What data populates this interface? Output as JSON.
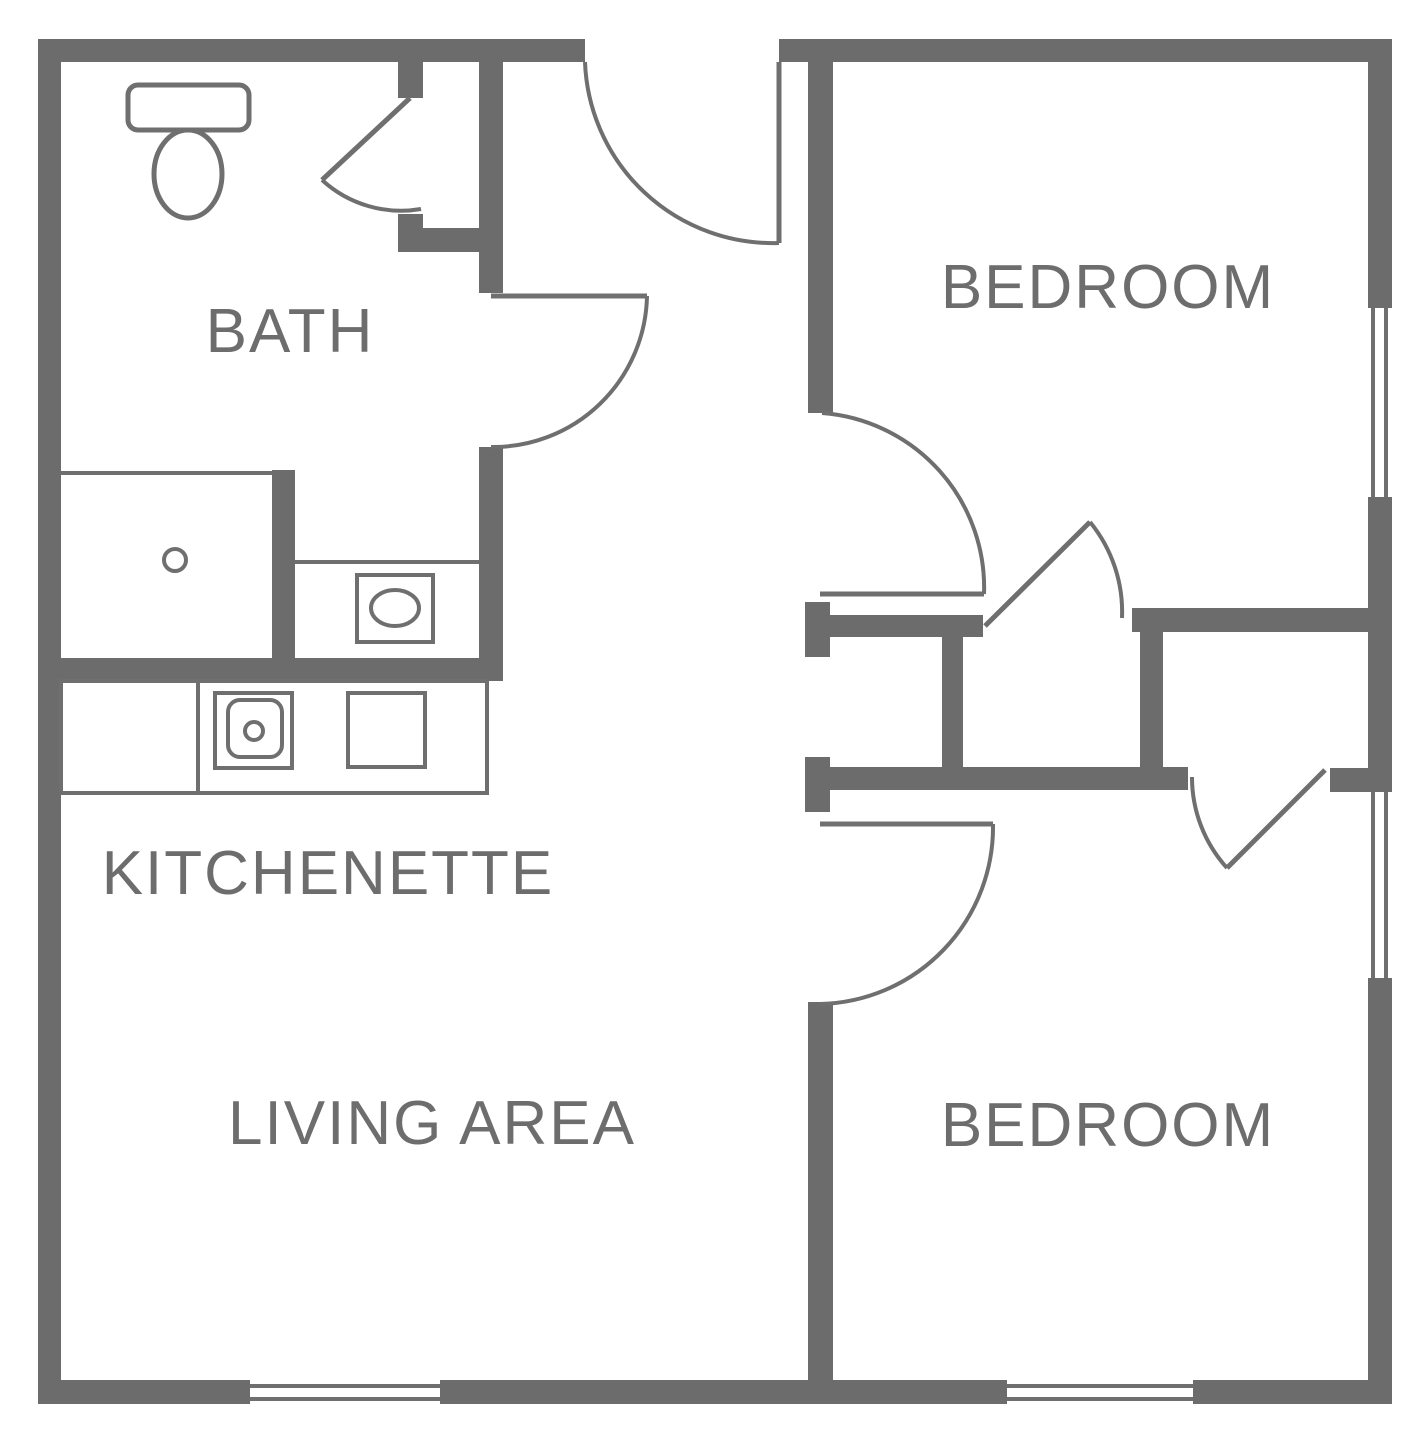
{
  "canvas": {
    "width": 1416,
    "height": 1434,
    "background": "#ffffff"
  },
  "colors": {
    "wall": "#6c6c6c",
    "line": "#6f6f6f",
    "text": "#6d6d6d",
    "fixture_fill": "#ffffff"
  },
  "labels": [
    {
      "name": "room-label-bath",
      "text": "BATH",
      "x": 290,
      "y": 352
    },
    {
      "name": "room-label-kitchenette",
      "text": "KITCHENETTE",
      "x": 328,
      "y": 894
    },
    {
      "name": "room-label-living-area",
      "text": "LIVING AREA",
      "x": 432,
      "y": 1144
    },
    {
      "name": "room-label-bedroom-top",
      "text": "BEDROOM",
      "x": 1108,
      "y": 308
    },
    {
      "name": "room-label-bedroom-bottom",
      "text": "BEDROOM",
      "x": 1108,
      "y": 1146
    }
  ],
  "walls": [
    {
      "name": "wall-top-left",
      "x": 38,
      "y": 39,
      "w": 547,
      "h": 23
    },
    {
      "name": "wall-top-right",
      "x": 779,
      "y": 39,
      "w": 613,
      "h": 23
    },
    {
      "name": "wall-left",
      "x": 38,
      "y": 39,
      "w": 23,
      "h": 1365
    },
    {
      "name": "wall-bottom-1",
      "x": 38,
      "y": 1380,
      "w": 212,
      "h": 24
    },
    {
      "name": "wall-bottom-2",
      "x": 440,
      "y": 1380,
      "w": 567,
      "h": 24
    },
    {
      "name": "wall-bottom-3",
      "x": 1193,
      "y": 1380,
      "w": 199,
      "h": 24
    },
    {
      "name": "wall-right-1",
      "x": 1368,
      "y": 39,
      "w": 24,
      "h": 269
    },
    {
      "name": "wall-right-2",
      "x": 1368,
      "y": 497,
      "w": 24,
      "h": 295
    },
    {
      "name": "wall-right-3",
      "x": 1368,
      "y": 978,
      "w": 24,
      "h": 426
    },
    {
      "name": "bath-closet-jamb-upper",
      "x": 398,
      "y": 62,
      "w": 25,
      "h": 36
    },
    {
      "name": "bath-closet-jamb-lower",
      "x": 398,
      "y": 214,
      "w": 25,
      "h": 38
    },
    {
      "name": "bath-closet-bottom-wall",
      "x": 398,
      "y": 228,
      "w": 105,
      "h": 24
    },
    {
      "name": "hall-bath-wall-upper",
      "x": 479,
      "y": 62,
      "w": 24,
      "h": 231
    },
    {
      "name": "hall-bath-wall-lower",
      "x": 479,
      "y": 447,
      "w": 24,
      "h": 234
    },
    {
      "name": "bath-south-wall",
      "x": 38,
      "y": 658,
      "w": 465,
      "h": 23
    },
    {
      "name": "shower-east-wall",
      "x": 272,
      "y": 470,
      "w": 23,
      "h": 188
    },
    {
      "name": "bedroom1-west-wall",
      "x": 808,
      "y": 62,
      "w": 25,
      "h": 351
    },
    {
      "name": "hall-closet-north-cap",
      "x": 805,
      "y": 602,
      "w": 25,
      "h": 55
    },
    {
      "name": "hall-closet-north-bar",
      "x": 805,
      "y": 615,
      "w": 178,
      "h": 22
    },
    {
      "name": "closet1-west-wall",
      "x": 942,
      "y": 637,
      "w": 21,
      "h": 130
    },
    {
      "name": "closet-north-bar-right",
      "x": 1132,
      "y": 608,
      "w": 236,
      "h": 24
    },
    {
      "name": "closet-divider-wall",
      "x": 1140,
      "y": 632,
      "w": 23,
      "h": 136
    },
    {
      "name": "hall-closet-south-cap",
      "x": 805,
      "y": 757,
      "w": 25,
      "h": 55
    },
    {
      "name": "hall-closet-south-bar",
      "x": 830,
      "y": 767,
      "w": 358,
      "h": 23
    },
    {
      "name": "closet2-south-stub",
      "x": 1330,
      "y": 768,
      "w": 38,
      "h": 24
    },
    {
      "name": "bedroom2-west-wall",
      "x": 808,
      "y": 1002,
      "w": 25,
      "h": 378
    }
  ],
  "windows": [
    {
      "name": "living-window-line-outer",
      "x1": 250,
      "y1": 1386,
      "x2": 440,
      "y2": 1386
    },
    {
      "name": "living-window-line-inner",
      "x1": 250,
      "y1": 1399,
      "x2": 440,
      "y2": 1399
    },
    {
      "name": "bedroom2-south-window-line-outer",
      "x1": 1007,
      "y1": 1386,
      "x2": 1193,
      "y2": 1386
    },
    {
      "name": "bedroom2-south-window-line-inner",
      "x1": 1007,
      "y1": 1399,
      "x2": 1193,
      "y2": 1399
    },
    {
      "name": "bedroom1-east-window-line-outer",
      "x1": 1373,
      "y1": 308,
      "x2": 1373,
      "y2": 497
    },
    {
      "name": "bedroom1-east-window-line-inner",
      "x1": 1386,
      "y1": 308,
      "x2": 1386,
      "y2": 497
    },
    {
      "name": "bedroom2-east-window-line-outer",
      "x1": 1373,
      "y1": 792,
      "x2": 1373,
      "y2": 978
    },
    {
      "name": "bedroom2-east-window-line-inner",
      "x1": 1386,
      "y1": 792,
      "x2": 1386,
      "y2": 978
    }
  ],
  "door_leaves": [
    {
      "name": "bath-closet-door-leaf",
      "x1": 410,
      "y1": 98,
      "x2": 322,
      "y2": 180
    },
    {
      "name": "bath-door-leaf",
      "x1": 491,
      "y1": 296,
      "x2": 647,
      "y2": 296
    },
    {
      "name": "entry-door-leaf",
      "x1": 779,
      "y1": 62,
      "x2": 779,
      "y2": 243
    },
    {
      "name": "bedroom1-door-leaf",
      "x1": 820,
      "y1": 594,
      "x2": 984,
      "y2": 594
    },
    {
      "name": "closet1-door-leaf",
      "x1": 985,
      "y1": 626,
      "x2": 1090,
      "y2": 522
    },
    {
      "name": "bedroom2-door-leaf",
      "x1": 820,
      "y1": 824,
      "x2": 993,
      "y2": 824
    },
    {
      "name": "closet2-door-leaf",
      "x1": 1325,
      "y1": 770,
      "x2": 1227,
      "y2": 868
    }
  ],
  "door_arcs": [
    {
      "name": "bath-closet-door-arc",
      "d": "M 322 180 A 117 117 0 0 0 421 209"
    },
    {
      "name": "bath-door-arc",
      "d": "M 647 296 A 154 154 0 0 1 491 447"
    },
    {
      "name": "entry-door-arc",
      "d": "M 585 62 A 188 188 0 0 0 779 243"
    },
    {
      "name": "bedroom1-door-arc",
      "d": "M 822 413 A 175 175 0 0 1 984 594"
    },
    {
      "name": "closet1-door-arc",
      "d": "M 1090 522 A 142 142 0 0 1 1122 618"
    },
    {
      "name": "bedroom2-door-arc",
      "d": "M 993 824 A 177 177 0 0 1 820 1004"
    },
    {
      "name": "closet2-door-arc",
      "d": "M 1192 777 A 135 135 0 0 0 1227 868"
    }
  ],
  "fixtures": [
    {
      "name": "toilet-bowl",
      "kind": "ellipse",
      "cx": 188,
      "cy": 174,
      "rx": 34,
      "ry": 44,
      "sw": 5,
      "f": "white"
    },
    {
      "name": "toilet-tank",
      "kind": "rect",
      "x": 128,
      "y": 85,
      "w": 121,
      "h": 45,
      "rx": 10,
      "sw": 5,
      "f": "white"
    },
    {
      "name": "shower-door-line",
      "kind": "line",
      "x1": 61,
      "y1": 473,
      "x2": 272,
      "y2": 473,
      "sw": 4
    },
    {
      "name": "shower-drain",
      "kind": "circle",
      "cx": 175,
      "cy": 560,
      "r": 11,
      "sw": 4,
      "f": "white"
    },
    {
      "name": "vanity-counter-line",
      "kind": "line",
      "x1": 295,
      "y1": 562,
      "x2": 479,
      "y2": 562,
      "sw": 4
    },
    {
      "name": "vanity-sink-box",
      "kind": "rect",
      "x": 357,
      "y": 575,
      "w": 76,
      "h": 67,
      "rx": 0,
      "sw": 4,
      "f": "white"
    },
    {
      "name": "vanity-sink-basin",
      "kind": "ellipse",
      "cx": 395,
      "cy": 608,
      "rx": 24,
      "ry": 18,
      "sw": 4,
      "f": "white"
    },
    {
      "name": "kitchen-counter",
      "kind": "rect",
      "x": 61,
      "y": 681,
      "w": 426,
      "h": 112,
      "rx": 0,
      "sw": 4,
      "f": "none"
    },
    {
      "name": "kitchen-counter-divider",
      "kind": "line",
      "x1": 198,
      "y1": 681,
      "x2": 198,
      "y2": 793,
      "sw": 4
    },
    {
      "name": "kitchen-sink-outer",
      "kind": "rect",
      "x": 215,
      "y": 693,
      "w": 77,
      "h": 75,
      "rx": 0,
      "sw": 4,
      "f": "white"
    },
    {
      "name": "kitchen-sink-inner",
      "kind": "rect",
      "x": 228,
      "y": 700,
      "w": 54,
      "h": 57,
      "rx": 12,
      "sw": 4,
      "f": "white"
    },
    {
      "name": "kitchen-sink-drain",
      "kind": "circle",
      "cx": 254,
      "cy": 731,
      "r": 9,
      "sw": 4,
      "f": "white"
    },
    {
      "name": "stove-burner",
      "kind": "rect",
      "x": 348,
      "y": 693,
      "w": 77,
      "h": 74,
      "rx": 0,
      "sw": 4,
      "f": "white"
    }
  ]
}
